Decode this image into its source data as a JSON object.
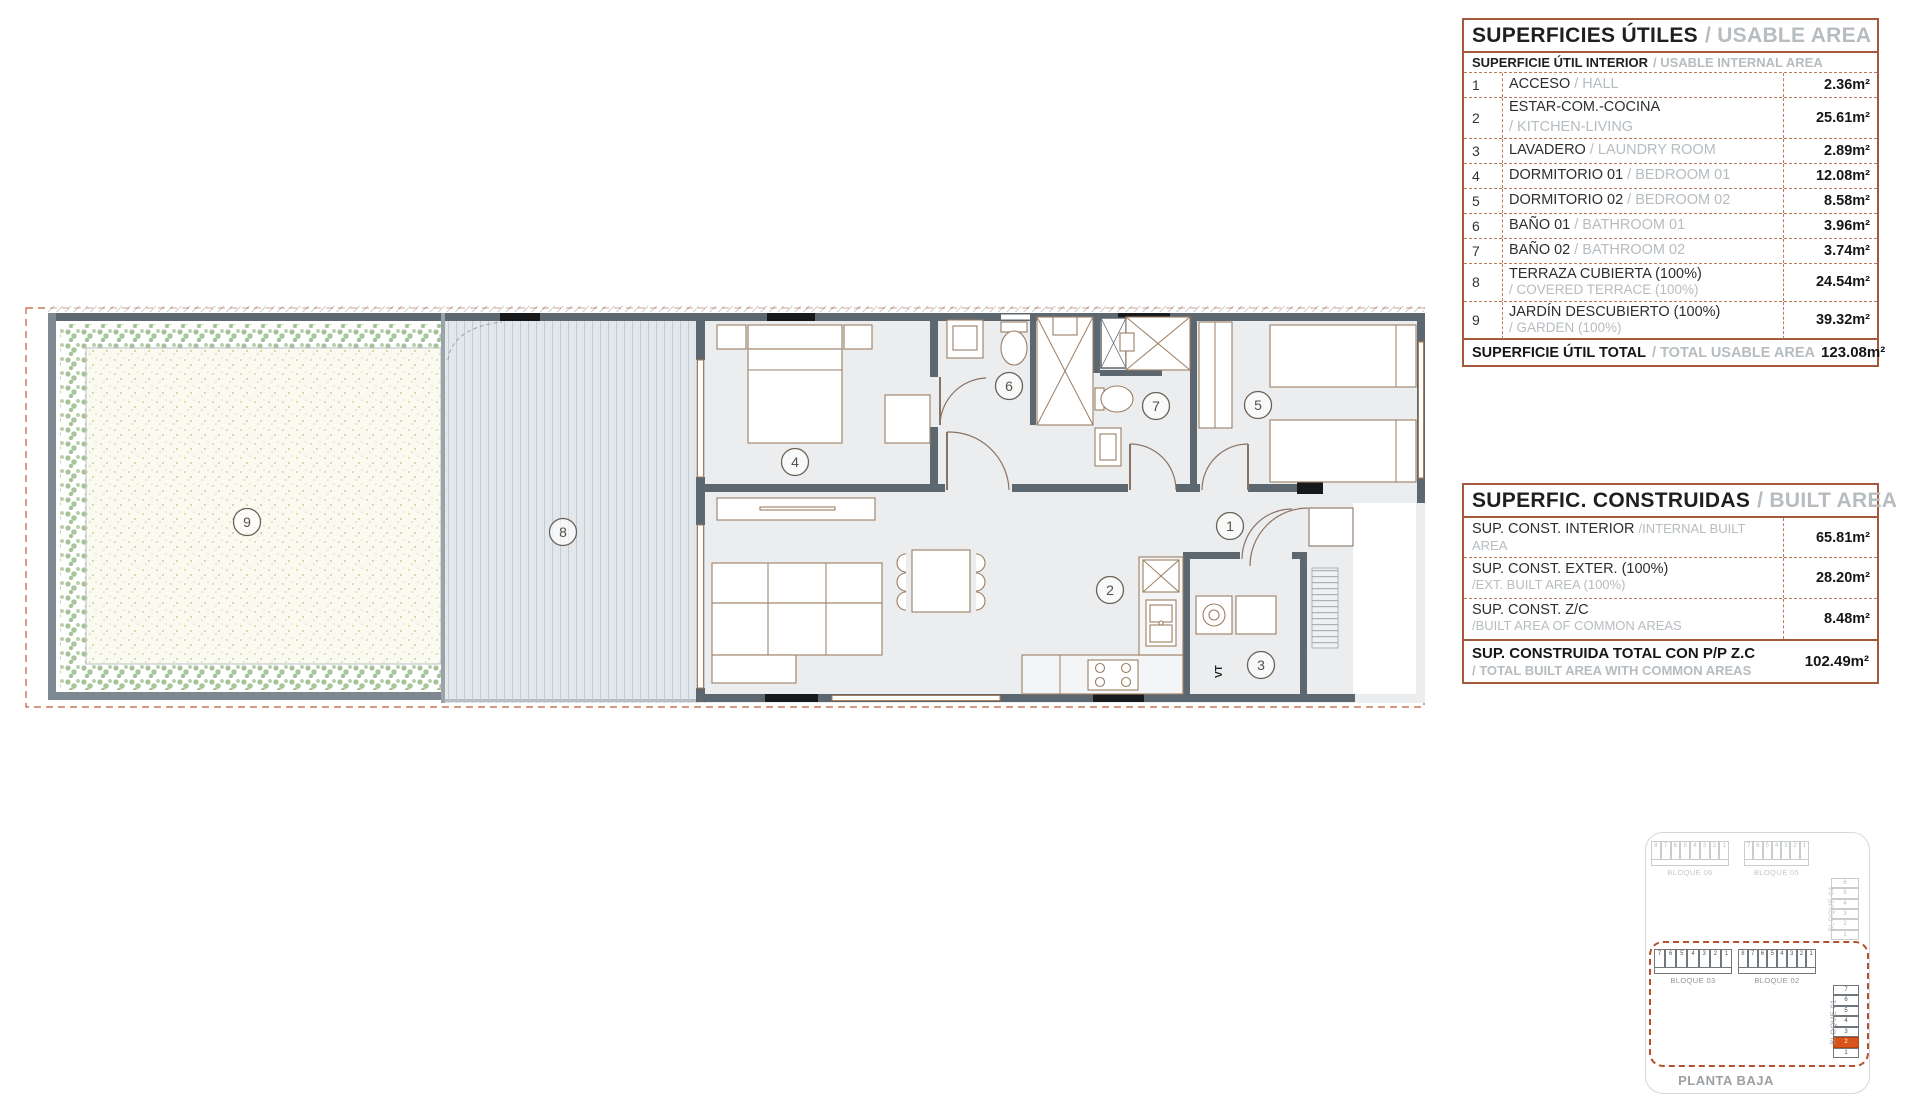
{
  "watermark": "Spain1.com",
  "usable_table": {
    "title_es": "SUPERFICIES ÚTILES",
    "title_en": "/ USABLE AREA",
    "subtitle_es": "SUPERFICIE ÚTIL INTERIOR",
    "subtitle_en": "/ USABLE INTERNAL AREA",
    "rows": [
      {
        "num": "1",
        "es": "ACCESO",
        "en": "/ HALL",
        "value": "2.36m²"
      },
      {
        "num": "2",
        "es": "ESTAR-COM.-COCINA",
        "en": "/ KITCHEN-LIVING",
        "value": "25.61m²"
      },
      {
        "num": "3",
        "es": "LAVADERO",
        "en": "/ LAUNDRY ROOM",
        "value": "2.89m²"
      },
      {
        "num": "4",
        "es": "DORMITORIO 01",
        "en": "/ BEDROOM 01",
        "value": "12.08m²"
      },
      {
        "num": "5",
        "es": "DORMITORIO 02",
        "en": "/ BEDROOM 02",
        "value": "8.58m²"
      },
      {
        "num": "6",
        "es": "BAÑO 01",
        "en": "/ BATHROOM 01",
        "value": "3.96m²"
      },
      {
        "num": "7",
        "es": "BAÑO 02",
        "en": "/ BATHROOM 02",
        "value": "3.74m²"
      },
      {
        "num": "8",
        "es": "TERRAZA CUBIERTA (100%)",
        "en": "/ COVERED TERRACE (100%)",
        "value": "24.54m²"
      },
      {
        "num": "9",
        "es": "JARDÍN DESCUBIERTO (100%)",
        "en": "/ GARDEN (100%)",
        "value": "39.32m²"
      }
    ],
    "total_es": "SUPERFICIE ÚTIL TOTAL",
    "total_en": "/ TOTAL USABLE AREA",
    "total_value": "123.08m²"
  },
  "built_table": {
    "title_es": "SUPERFIC. CONSTRUIDAS",
    "title_en": "/ BUILT AREA",
    "rows": [
      {
        "es": "SUP. CONST. INTERIOR",
        "en": "/INTERNAL BUILT AREA",
        "value": "65.81m²"
      },
      {
        "es": "SUP. CONST. EXTER. (100%)",
        "en": "/EXT. BUILT AREA (100%)",
        "value": "28.20m²"
      },
      {
        "es": "SUP. CONST. Z/C",
        "en": "/BUILT AREA OF COMMON AREAS",
        "value": "8.48m²"
      }
    ],
    "total_es": "SUP. CONSTRUIDA TOTAL CON P/P Z.C",
    "total_en": "/ TOTAL BUILT AREA WITH COMMON AREAS",
    "total_value": "102.49m²"
  },
  "floorplan": {
    "room_labels": [
      "1",
      "2",
      "3",
      "4",
      "5",
      "6",
      "7",
      "8",
      "9"
    ],
    "vt_label": "VT"
  },
  "locator": {
    "caption": "PLANTA BAJA",
    "highlight_color": "#d9531d",
    "blocks": [
      {
        "label": "BLOQUE 06",
        "units": [
          "8",
          "7",
          "6",
          "5",
          "4",
          "3",
          "2",
          "1"
        ],
        "state": "faded",
        "orient": "h"
      },
      {
        "label": "BLOQUE 05",
        "units": [
          "7",
          "6",
          "5",
          "4",
          "3",
          "2",
          "1"
        ],
        "state": "faded",
        "orient": "h"
      },
      {
        "label": "BLOQUE 04",
        "units": [
          "6",
          "5",
          "4",
          "3",
          "2",
          "1"
        ],
        "state": "faded",
        "orient": "v"
      },
      {
        "label": "BLOQUE 03",
        "units": [
          "7",
          "6",
          "5",
          "4",
          "3",
          "2",
          "1"
        ],
        "state": "active",
        "orient": "h"
      },
      {
        "label": "BLOQUE 02",
        "units": [
          "8",
          "7",
          "6",
          "5",
          "4",
          "3",
          "2",
          "1"
        ],
        "state": "active",
        "orient": "h"
      },
      {
        "label": "BLOQUE 01",
        "units": [
          "7",
          "6",
          "5",
          "4",
          "3",
          "2",
          "1"
        ],
        "state": "active",
        "orient": "v",
        "highlighted_unit": "2"
      }
    ]
  }
}
